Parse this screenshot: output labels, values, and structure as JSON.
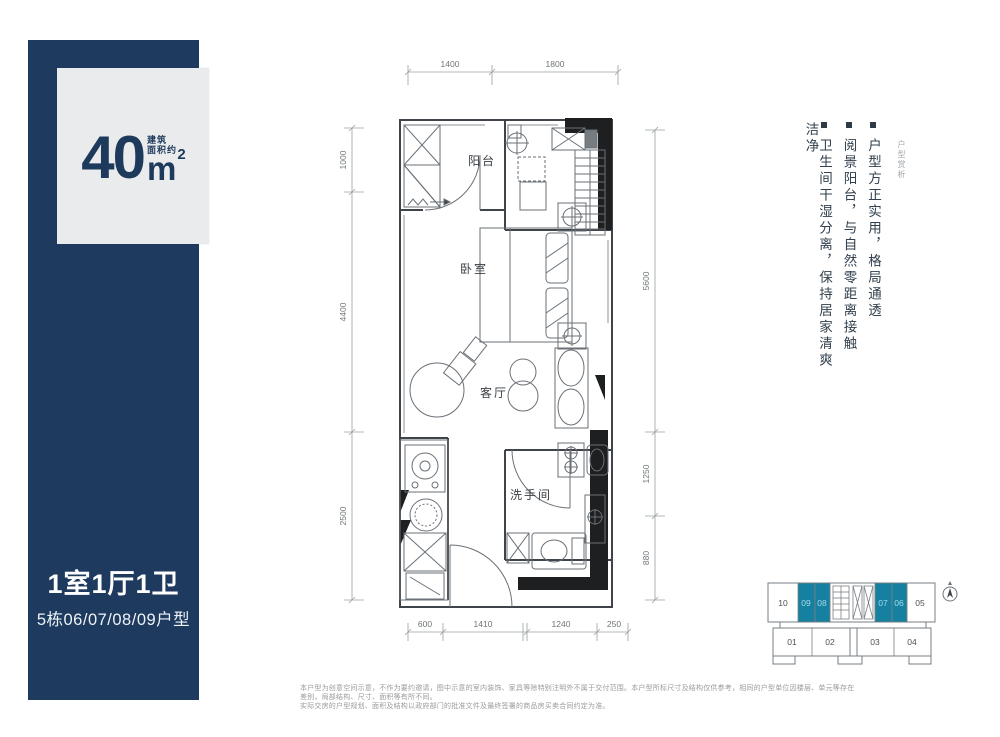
{
  "colors": {
    "navy": "#1e3a5e",
    "card_gray": "#e9ebec",
    "teal_highlight": "#15809f",
    "teal_label": "#a3dcec",
    "feature_text": "#33404d",
    "wall": "#3f444a",
    "dim_text": "#6f7478",
    "disclaimer_text": "#9b9b9b"
  },
  "sidebar": {
    "area_value": "40",
    "area_label_1": "建筑",
    "area_label_2": "面积约",
    "area_unit": "m",
    "area_sup": "2",
    "type_title": "1室1厅1卫",
    "type_subtitle": "5栋06/07/08/09户型"
  },
  "features": {
    "section_label": "户型赏析",
    "items": [
      "户型方正实用，格局通透",
      "阅景阳台，与自然零距离接触",
      "卫生间干湿分离，保持居家清爽洁净"
    ]
  },
  "floorplan": {
    "rooms": {
      "balcony": "阳台",
      "bedroom": "卧室",
      "living": "客厅",
      "bathroom": "洗手间"
    },
    "dims": {
      "top": [
        "1400",
        "1800"
      ],
      "left": [
        "1000",
        "4400",
        "2500"
      ],
      "right": [
        "5600",
        "1250",
        "880"
      ],
      "bottom": [
        "600",
        "1410",
        "1240",
        "250"
      ]
    }
  },
  "keyplan": {
    "top_units": [
      {
        "label": "10",
        "highlighted": false
      },
      {
        "label": "09",
        "highlighted": true
      },
      {
        "label": "08",
        "highlighted": true
      },
      {
        "label": "07",
        "highlighted": true
      },
      {
        "label": "06",
        "highlighted": true
      },
      {
        "label": "05",
        "highlighted": false
      }
    ],
    "bottom_units": [
      "01",
      "02",
      "03",
      "04"
    ]
  },
  "disclaimer": {
    "line1": "本户型为创意空间示意，不作为要约邀请，图中示意的室内装饰、家具等除特别注明外不属于交付范围。本户型所标尺寸及结构仅供参考，相同的户型单位因楼层、单元等存在差别，局部结构、尺寸、面积等有所不同。",
    "line2": "实际交房的户型规划、面积及结构以政府部门的批准文件及最终签署的商品房买卖合同约定为准。"
  }
}
